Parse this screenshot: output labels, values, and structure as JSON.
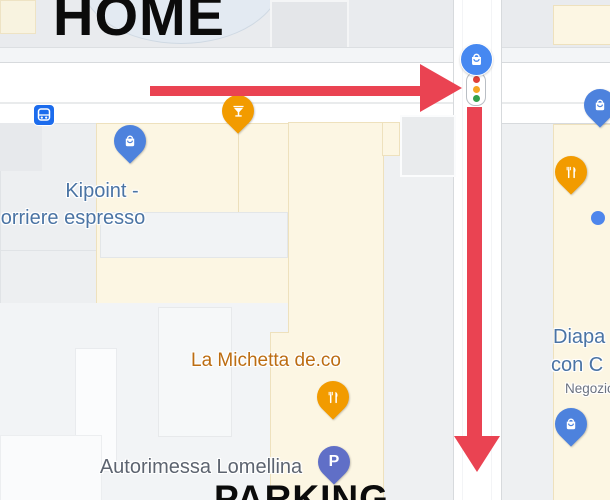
{
  "annotations": {
    "home_label": "HOME",
    "parking_label": "PARKING",
    "route_arrows": [
      "right-arrow-at-intersection",
      "down-arrow-along-street"
    ],
    "route_color": "#ea4352"
  },
  "poi_labels": {
    "kipoint_line1": "Kipoint -",
    "kipoint_line2": "orriere espresso",
    "michetta": "La Michetta de.co",
    "autorimessa": "Autorimessa Lomellina",
    "right_store_line1": "Diapa",
    "right_store_line2": "con C",
    "right_store_line3": "Negozio",
    "parking_pin_letter": "P"
  },
  "icons": {
    "bus_stop": "bus-stop-icon",
    "traffic_light": "traffic-light-icon",
    "intersection_badge": "shopping-badge-icon",
    "shopping_pins": [
      "kipoint-shopping-pin",
      "right-top-shopping-pin",
      "right-bottom-shopping-pin"
    ],
    "food_pins": [
      "cocktail-pin",
      "restaurant-pin-right",
      "restaurant-pin-center"
    ],
    "parking_pin": "parking-pin",
    "poi_dot": "small-poi-dot"
  },
  "colors": {
    "route_red": "#ea4352",
    "shopping_pin_blue": "#4d82dd",
    "badge_blue": "#4688f1",
    "food_pin_orange": "#f29b00",
    "parking_pin_indigo": "#606fc7",
    "bus_icon_blue": "#1c6ced",
    "poi_label_blue": "#4b74a4",
    "food_label_orange": "#bc6d12",
    "gray_label": "#5d6470",
    "road_white": "#ffffff",
    "building_cream": "#fcf6e3",
    "map_background": "#eef0f2",
    "traffic_red": "#e04138",
    "traffic_amber": "#f5a623",
    "traffic_green": "#34a04a"
  }
}
